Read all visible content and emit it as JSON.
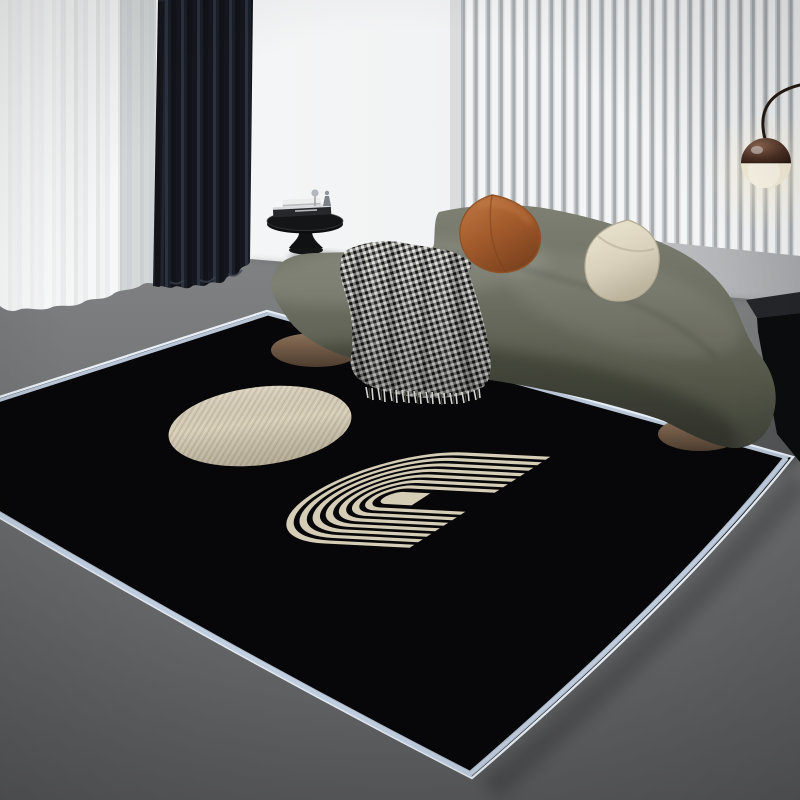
{
  "image": {
    "kind": "interior product photograph",
    "width_px": 800,
    "height_px": 800,
    "visible_text": "none"
  },
  "colors": {
    "wall_white": "#f7f8f8",
    "wall_mid": "#eef0f1",
    "wall_shadow": "#dcdee0",
    "slat_face": "#f4f5f6",
    "slat_gap": "#a8abae",
    "floor_top": "#7d7f81",
    "floor_bottom": "#58595b",
    "rug_black": "#070709",
    "rug_trim_white": "#e9eff7",
    "rug_trim_blue": "#c2d0e2",
    "motif_beige": "#d6cdb7",
    "sofa_light": "#7e8073",
    "sofa_dark": "#3a3c34",
    "pillow_rust": "#a65a2d",
    "pillow_cream": "#e6dfca",
    "throw_light": "#e9e9e6",
    "throw_dark": "#171717",
    "wood": "#7b6450",
    "curtain_sheer": "#f3f4f4",
    "curtain_black": "#14171d",
    "lamp_glow": "#f5eeda",
    "lamp_dark": "#3c2a20",
    "console_black": "#0b0c0e",
    "table_black": "#141517"
  },
  "objects": {
    "scene": {
      "label": "modern living room with black geometric area rug"
    },
    "wall": {
      "label": "white wall"
    },
    "slat_panel": {
      "label": "white vertical slat wall panel"
    },
    "sheer_curtain": {
      "label": "white sheer curtain"
    },
    "black_curtain": {
      "label": "dark blackout curtain"
    },
    "floor": {
      "label": "dark gray floor"
    },
    "rug": {
      "label": "black rug with pale-blue serged border"
    },
    "circle_motif": {
      "label": "beige woven circle motif"
    },
    "arch_motif": {
      "label": "beige concentric arch stripe motif"
    },
    "sofa": {
      "label": "curved olive-gray sofa on wooden plinth"
    },
    "pillow_rust": {
      "label": "caramel leather cushion"
    },
    "pillow_cream": {
      "label": "cream cushion"
    },
    "throw": {
      "label": "black-and-white checked throw blanket with fringe"
    },
    "side_table": {
      "label": "black pedestal side table with books and decor objects"
    },
    "books": {
      "label": "stacked books"
    },
    "decor": {
      "label": "small glass decor objects"
    },
    "console": {
      "label": "black low console"
    },
    "lamp": {
      "label": "arc floor lamp with two-tone globe shade"
    }
  }
}
